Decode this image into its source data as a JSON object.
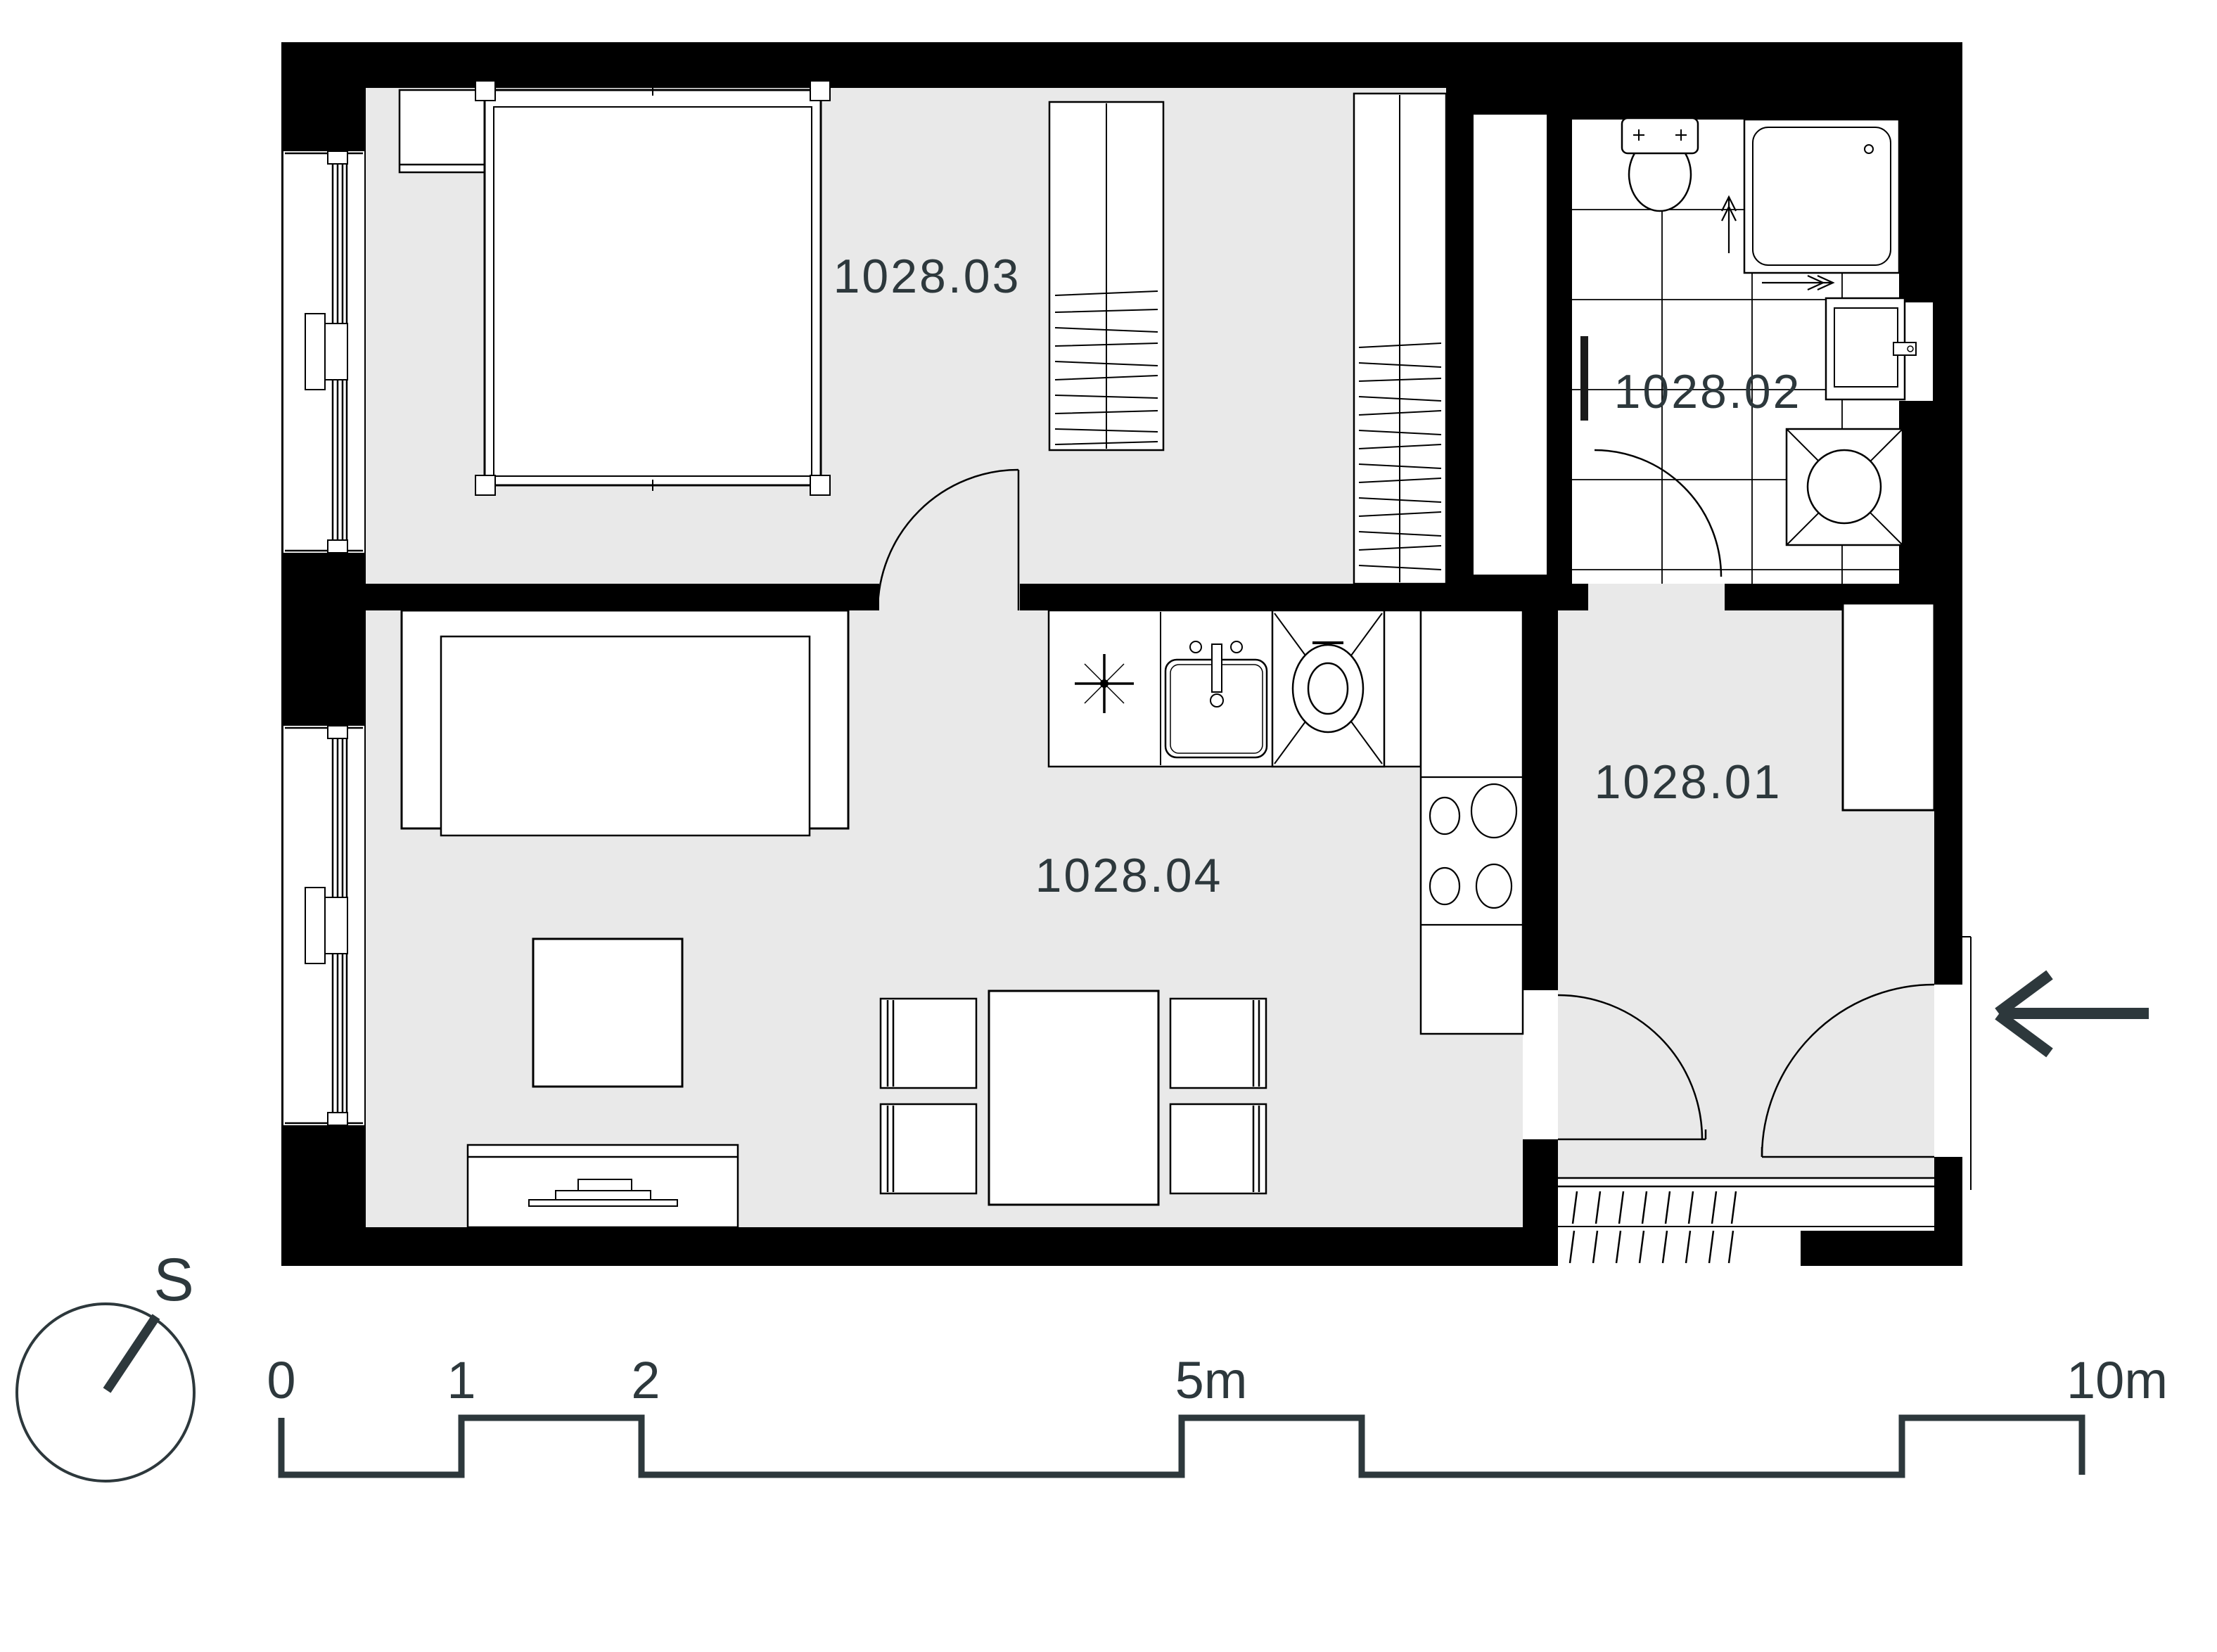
{
  "title": "Apartment unit floor plan",
  "colors": {
    "wall": "#000000",
    "floor_fill": "#e9e9e9",
    "accent_text": "#2d383c",
    "fixture_fill": "#ffffff",
    "line": "#000000"
  },
  "rooms": [
    {
      "id": "1028.01",
      "name": "entry-hall"
    },
    {
      "id": "1028.02",
      "name": "bathroom"
    },
    {
      "id": "1028.03",
      "name": "bedroom"
    },
    {
      "id": "1028.04",
      "name": "living-room-kitchen"
    }
  ],
  "compass": {
    "label": "S"
  },
  "scale_bar": {
    "unit": "m",
    "ticks": [
      {
        "label": "0"
      },
      {
        "label": "1"
      },
      {
        "label": "2"
      },
      {
        "label": "5m"
      },
      {
        "label": "10m"
      }
    ]
  },
  "entrance": {
    "indicator": "arrow-left"
  }
}
